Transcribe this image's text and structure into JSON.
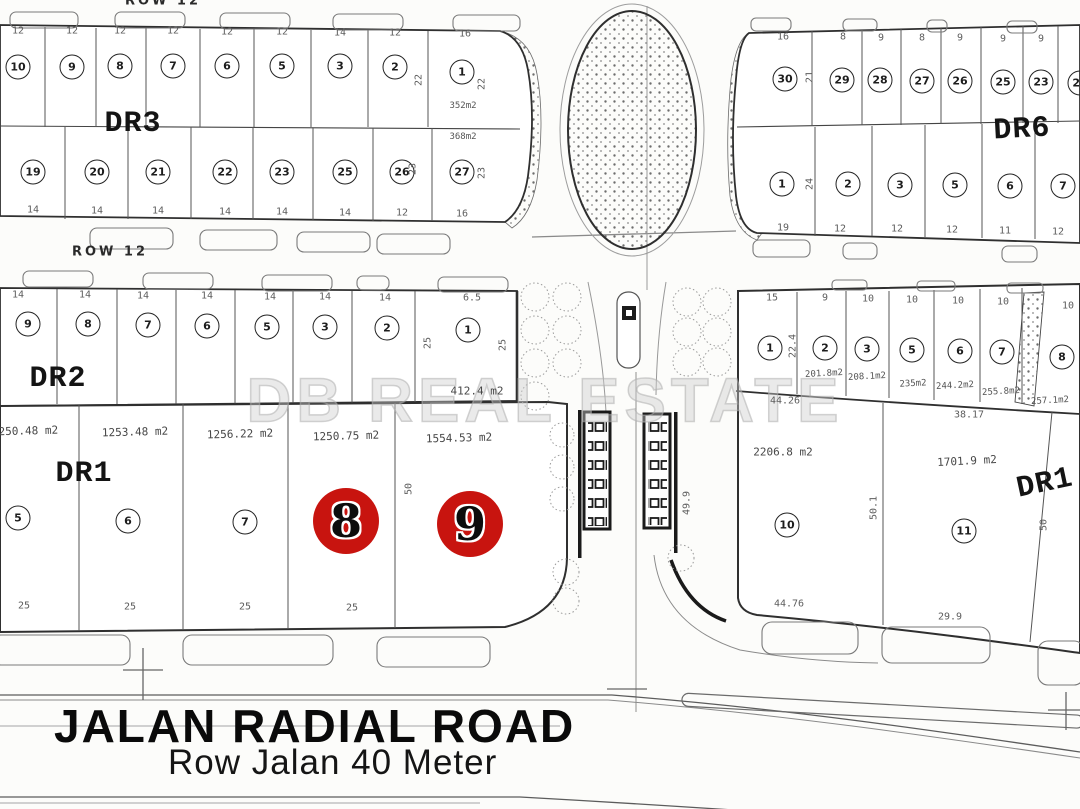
{
  "watermark": "DB REAL ESTATE",
  "road": {
    "name": "JALAN RADIAL ROAD",
    "subtitle": "Row Jalan 40 Meter"
  },
  "row_labels": {
    "dr3_bottom": "ROW 12",
    "top_edge": "ROW 12"
  },
  "highlight": {
    "color": "#c8140f",
    "plots": [
      "8",
      "9"
    ]
  },
  "blocks": {
    "dr3": {
      "label": "DR3",
      "top_plots": [
        "10",
        "9",
        "8",
        "7",
        "6",
        "5",
        "3",
        "2",
        "1"
      ],
      "top_dims": [
        "12",
        "12",
        "12",
        "12",
        "12",
        "12",
        "14",
        "12",
        "16"
      ],
      "bottom_plots": [
        "19",
        "20",
        "21",
        "22",
        "23",
        "25",
        "26",
        "27"
      ],
      "bottom_dims": [
        "14",
        "14",
        "14",
        "14",
        "14",
        "14",
        "12",
        "16"
      ],
      "areas": [
        "352m2",
        "368m2"
      ],
      "side_dims": [
        "22",
        "22",
        "23",
        "23"
      ]
    },
    "dr6": {
      "label": "DR6",
      "top_plots": [
        "30",
        "29",
        "28",
        "27",
        "26",
        "25",
        "23",
        "22"
      ],
      "top_dims": [
        "16",
        "8",
        "9",
        "8",
        "9",
        "9",
        "9"
      ],
      "bottom_plots": [
        "1",
        "2",
        "3",
        "5",
        "6",
        "7"
      ],
      "bottom_dims": [
        "19",
        "12",
        "12",
        "12",
        "11",
        "12"
      ],
      "side_dims": [
        "21",
        "24"
      ]
    },
    "dr2": {
      "label": "DR2",
      "plots": [
        "9",
        "8",
        "7",
        "6",
        "5",
        "3",
        "2",
        "1"
      ],
      "top_dims": [
        "14",
        "14",
        "14",
        "14",
        "14",
        "14",
        "14"
      ],
      "corner_dim": "6.5",
      "area": "412.4 m2",
      "side_dims": [
        "25",
        "25"
      ]
    },
    "dr1_left": {
      "label": "DR1",
      "areas": [
        "1250.48 m2",
        "1253.48 m2",
        "1256.22 m2",
        "1250.75 m2",
        "1554.53 m2"
      ],
      "plots": [
        "5",
        "6",
        "7"
      ],
      "bottom_dims": [
        "25",
        "25",
        "25",
        "25"
      ],
      "side_dim": "50"
    },
    "dr1_right": {
      "label": "DR1",
      "top_plots": [
        "1",
        "2",
        "3",
        "5",
        "6",
        "7",
        "8"
      ],
      "top_dims": [
        "15",
        "9",
        "10",
        "10",
        "10",
        "10",
        "10"
      ],
      "top_areas": [
        "201.8m2",
        "208.1m2",
        "235m2",
        "244.2m2",
        "255.8m2",
        "257.1m2"
      ],
      "top_side_dim": "22.4",
      "width_dims": [
        "44.26",
        "38.17"
      ],
      "plots": [
        "10",
        "11"
      ],
      "areas": [
        "2206.8 m2",
        "1701.9 m2"
      ],
      "depth_dims": [
        "50.1",
        "50"
      ],
      "bottom_dims": [
        "44.76",
        "29.9"
      ],
      "road_dim": "49.9"
    }
  }
}
